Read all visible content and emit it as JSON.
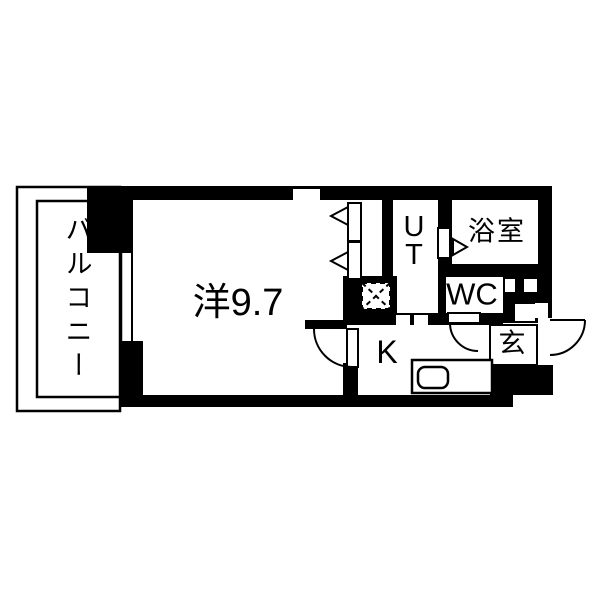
{
  "floorplan": {
    "type": "apartment-floor-plan",
    "rooms": [
      {
        "id": "balcony",
        "label": "バルコニー"
      },
      {
        "id": "western-room",
        "label": "洋9.7"
      },
      {
        "id": "utility",
        "label": "UT"
      },
      {
        "id": "bathroom",
        "label": "浴室"
      },
      {
        "id": "toilet",
        "label": "WC"
      },
      {
        "id": "kitchen",
        "label": "K"
      },
      {
        "id": "entrance",
        "label": "玄"
      }
    ],
    "symbols": [
      "entrance-door-swing",
      "room-door-swing",
      "wc-door-swing",
      "closet-sliding-doors",
      "sliding-door-triangles",
      "refrigerator-space-dashed",
      "kitchen-sink",
      "balcony-window"
    ],
    "colors": {
      "wall": "#000000",
      "floor": "#ffffff",
      "line": "#000000"
    }
  }
}
